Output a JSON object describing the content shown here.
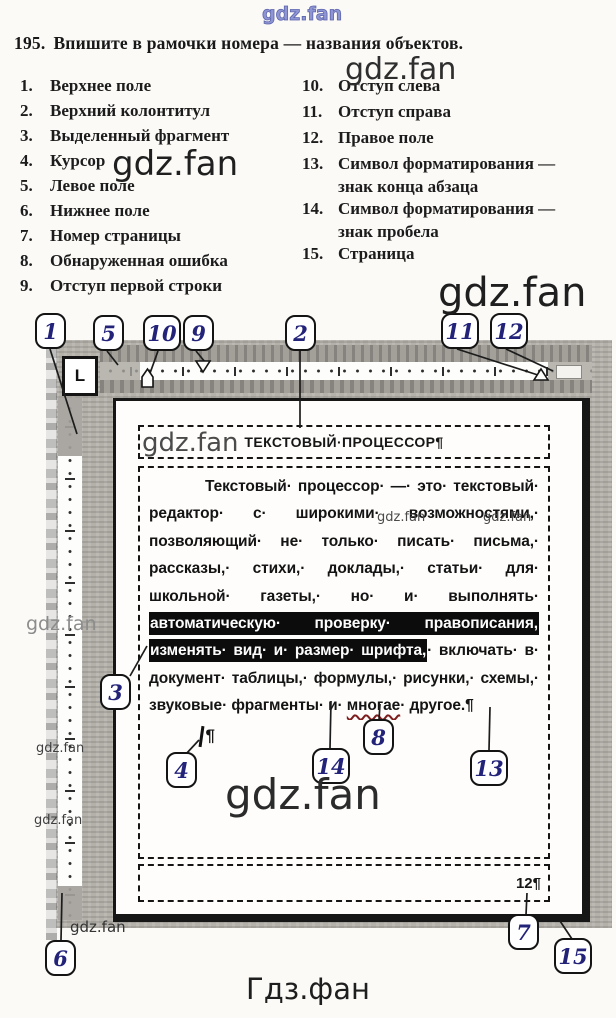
{
  "brand": {
    "watermark": "gdz.fan",
    "watermark_cyrillic": "Гдз.фан"
  },
  "exercise": {
    "number": "195.",
    "title": "Впишите в рамочки номера — названия объектов.",
    "items_left": [
      {
        "n": "1.",
        "t": "Верхнее поле"
      },
      {
        "n": "2.",
        "t": "Верхний колонтитул"
      },
      {
        "n": "3.",
        "t": "Выделенный фрагмент"
      },
      {
        "n": "4.",
        "t": "Курсор"
      },
      {
        "n": "5.",
        "t": "Левое поле"
      },
      {
        "n": "6.",
        "t": "Нижнее поле"
      },
      {
        "n": "7.",
        "t": "Номер страницы"
      },
      {
        "n": "8.",
        "t": "Обнаруженная ошибка"
      },
      {
        "n": "9.",
        "t": "Отступ первой строки"
      }
    ],
    "items_right": [
      {
        "n": "10.",
        "t": "Отступ слева"
      },
      {
        "n": "11.",
        "t": "Отступ справа"
      },
      {
        "n": "12.",
        "t": "Правое поле"
      },
      {
        "n": "13.",
        "t": "Символ форматирования —",
        "t2": "знак конца абзаца"
      },
      {
        "n": "14.",
        "t": "Символ форматирования —",
        "t2": "знак пробела"
      },
      {
        "n": "15.",
        "t": "Страница"
      }
    ]
  },
  "diagram": {
    "tab_selector_label": "L",
    "callouts": {
      "c1": "1",
      "c2": "2",
      "c3": "3",
      "c4": "4",
      "c5": "5",
      "c6": "6",
      "c7": "7",
      "c8": "8",
      "c9": "9",
      "c10": "10",
      "c11": "11",
      "c12": "12",
      "c13": "13",
      "c14": "14",
      "c15": "15"
    },
    "document": {
      "header_text": "ТЕКСТОВЫЙ·ПРОЦЕССОР¶",
      "lines": [
        {
          "indent": true,
          "segments": [
            {
              "t": "Текстовый· процессор· —· это· текстовый·"
            }
          ]
        },
        {
          "segments": [
            {
              "t": "редактор· с· широкими· возможностями,·"
            }
          ]
        },
        {
          "segments": [
            {
              "t": "позволяющий· не· только· писать· письма,·"
            }
          ]
        },
        {
          "segments": [
            {
              "t": "рассказы,· стихи,· доклады,· статьи· для·"
            }
          ]
        },
        {
          "segments": [
            {
              "t": "школьной· газеты,· но· и· выполнять·"
            }
          ]
        },
        {
          "segments": [
            {
              "t": "автоматическую· проверку· правописания,",
              "hl": true
            }
          ]
        },
        {
          "segments": [
            {
              "t": "изменять· вид· и· размер· шрифта,",
              "hl": true
            },
            {
              "t": "· включать· в·"
            }
          ]
        },
        {
          "segments": [
            {
              "t": "документ· таблицы,· формулы,· рисунки,· схемы,·"
            }
          ]
        },
        {
          "last": true,
          "segments": [
            {
              "t": "звуковые· фрагменты· и· "
            },
            {
              "t": "многае",
              "wavy": true
            },
            {
              "t": "· другое.¶"
            }
          ]
        }
      ],
      "cursor_pilcrow": "¶",
      "page_number": "12¶"
    }
  }
}
